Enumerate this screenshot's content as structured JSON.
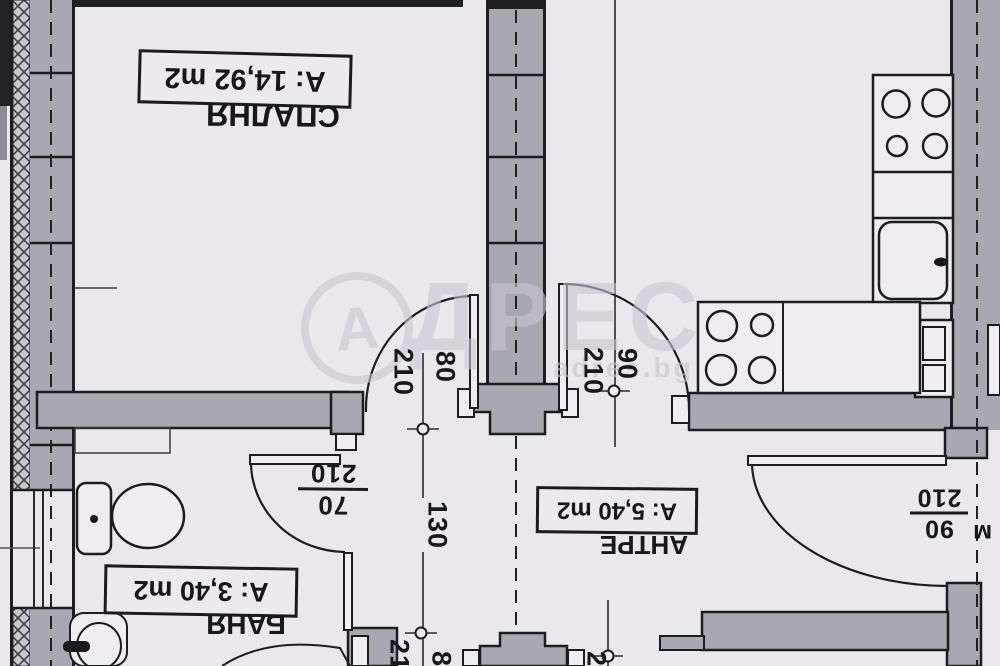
{
  "rooms": {
    "bedroom": {
      "name": "СПАЛНЯ",
      "area": "A: 14,92 m2"
    },
    "bathroom": {
      "name": "БАНЯ",
      "area": "A: 3,40 m2"
    },
    "hall": {
      "name": "АНТРЕ",
      "area": "A: 5,40 m2"
    }
  },
  "dimensions": {
    "bedroom_door": {
      "width": "80",
      "height": "210"
    },
    "kitchen_door": {
      "width": "90",
      "height": "210"
    },
    "bathroom_door": {
      "width": "70",
      "height": "210"
    },
    "entry_door": {
      "width": "90",
      "height": "210"
    },
    "hall_width": "130",
    "partial_height": "21",
    "partial_width": "8",
    "partial_small": "2",
    "partial_right": "м"
  },
  "watermark": {
    "logo_letter": "А",
    "brand": "ДРЕС",
    "site": "adres.bg"
  },
  "colors": {
    "wall": "#a9a7af",
    "paper": "#eae8ed",
    "line": "#1d1c21"
  }
}
